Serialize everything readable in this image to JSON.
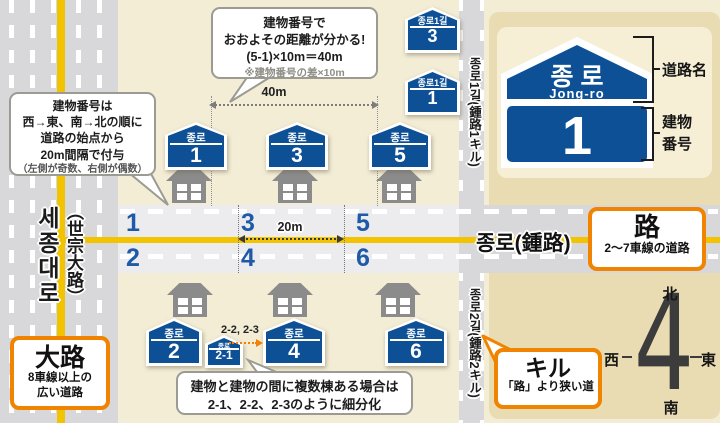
{
  "callouts": {
    "numbering": {
      "l1": "建物番号は",
      "l2": "西→東、南→北の順に",
      "l3": "道路の始点から",
      "l4": "20m間隔で付与",
      "l5": "（左側が奇数、右側が偶数）"
    },
    "distance": {
      "l1": "建物番号で",
      "l2": "おおよその距離が分かる!",
      "l3": "(5-1)×10m＝40m",
      "note": "※建物番号の差×10m"
    },
    "subdivision": {
      "l1": "建物と建物の間に複数棟ある場合は",
      "l2": "2-1、2-2、2-3のように細分化"
    }
  },
  "roads": {
    "sejong_kr": "세종대로",
    "sejong_ja": "（世宗大路）",
    "jongro": "종로(鍾路)",
    "gil1": "종로1길(鍾路1キル)",
    "gil2": "종로2길(鍾路2キル)"
  },
  "legend": {
    "daero": {
      "title": "大路",
      "desc1": "8車線以上の",
      "desc2": "広い道路"
    },
    "ro": {
      "title": "路",
      "desc": "2〜7車線の道路"
    },
    "gil": {
      "title": "キル",
      "desc": "「路」より狭い道"
    }
  },
  "example_sign": {
    "road_kr": "종 로",
    "road_en": "Jong-ro",
    "number": "1",
    "caption_road": "道路名",
    "caption_building_l1": "建物",
    "caption_building_l2": "番号"
  },
  "signs": {
    "top": [
      {
        "label": "종로",
        "num": "1"
      },
      {
        "label": "종로",
        "num": "3"
      },
      {
        "label": "종로",
        "num": "5"
      }
    ],
    "bottom": [
      {
        "label": "종로",
        "num": "2"
      },
      {
        "label": "종로",
        "num": "4"
      },
      {
        "label": "종로",
        "num": "6"
      }
    ],
    "small": {
      "label": "종로",
      "num": "2-1"
    },
    "gil": [
      {
        "label": "종로1길",
        "num": "3"
      },
      {
        "label": "종로1길",
        "num": "1"
      }
    ]
  },
  "lane_numbers": {
    "top": [
      "1",
      "3",
      "5"
    ],
    "bottom": [
      "2",
      "4",
      "6"
    ]
  },
  "measurements": {
    "m40": "40m",
    "m20": "20m",
    "subdivision_note": "2-2, 2-3"
  },
  "compass": {
    "north": "北",
    "south": "南",
    "east": "東",
    "west": "西",
    "number": "4"
  },
  "colors": {
    "sign_blue": "#0d5096",
    "accent_orange": "#f08300",
    "road_gray": "#d8d8da",
    "road_light": "#ececef",
    "lane_yellow": "#f2c300",
    "panel_tan": "#e9dcb2",
    "background_beige": "#f3edd6"
  }
}
